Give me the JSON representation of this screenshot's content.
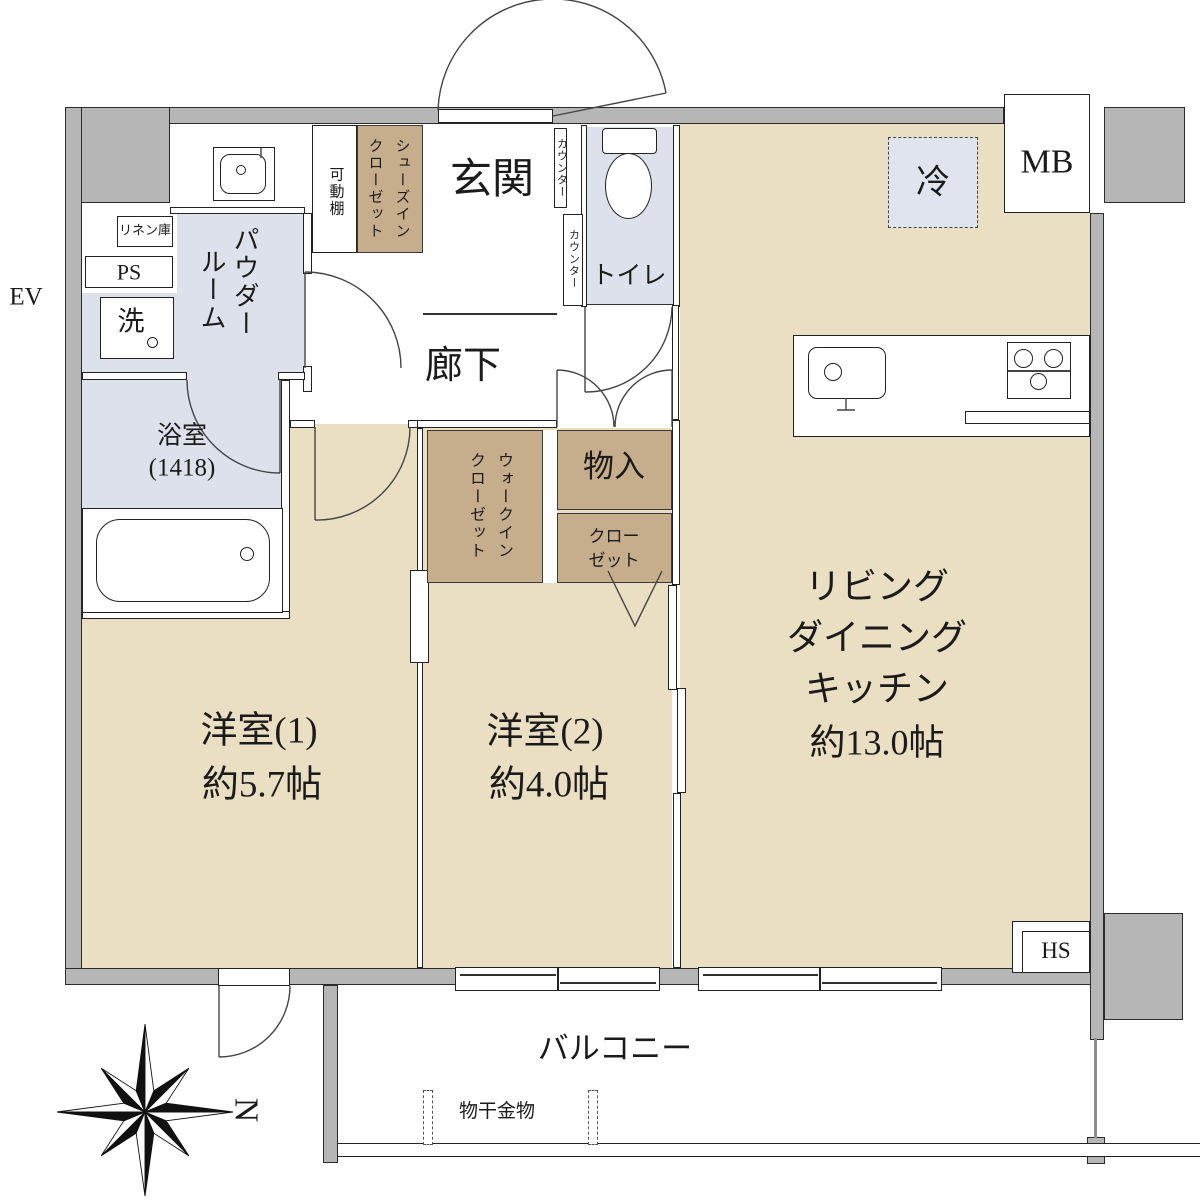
{
  "meta": {
    "kind": "apartment-floor-plan",
    "units_note": "Japanese madori drawing"
  },
  "colors": {
    "floor_beige": "#eadfc2",
    "wet_blue": "#dce1ec",
    "closet_brown": "#c6ae8d",
    "fridge_blue": "#e0e4ef",
    "wall_gray": "#b6b6b6"
  },
  "labels": {
    "ev": "EV",
    "mb": "MB",
    "ps": "PS",
    "hs": "HS",
    "entrance": "玄関",
    "hallway": "廊下",
    "toilet": "トイレ",
    "powder_room_col1": "パウダー",
    "powder_room_col2": "ルーム",
    "linen": "リネン庫",
    "washer": "洗",
    "bath_name": "浴室",
    "bath_size": "(1418)",
    "movable_shelf": "可動棚",
    "shoe_closet_col1": "シューズイン",
    "shoe_closet_col2": "クローゼット",
    "counter1": "カウンター",
    "counter2": "カウンター",
    "fridge": "冷",
    "wic_col1": "ウォークイン",
    "wic_col2": "クローゼット",
    "storage": "物入",
    "closet_line1": "クロー",
    "closet_line2": "ゼット",
    "room1_name": "洋室(1)",
    "room1_size": "約5.7帖",
    "room2_name": "洋室(2)",
    "room2_size": "約4.0帖",
    "ldk_line1": "リビング",
    "ldk_line2": "ダイニング",
    "ldk_line3": "キッチン",
    "ldk_size": "約13.0帖",
    "balcony": "バルコニー",
    "laundry_hw": "物干金物",
    "compass_north": "N"
  }
}
